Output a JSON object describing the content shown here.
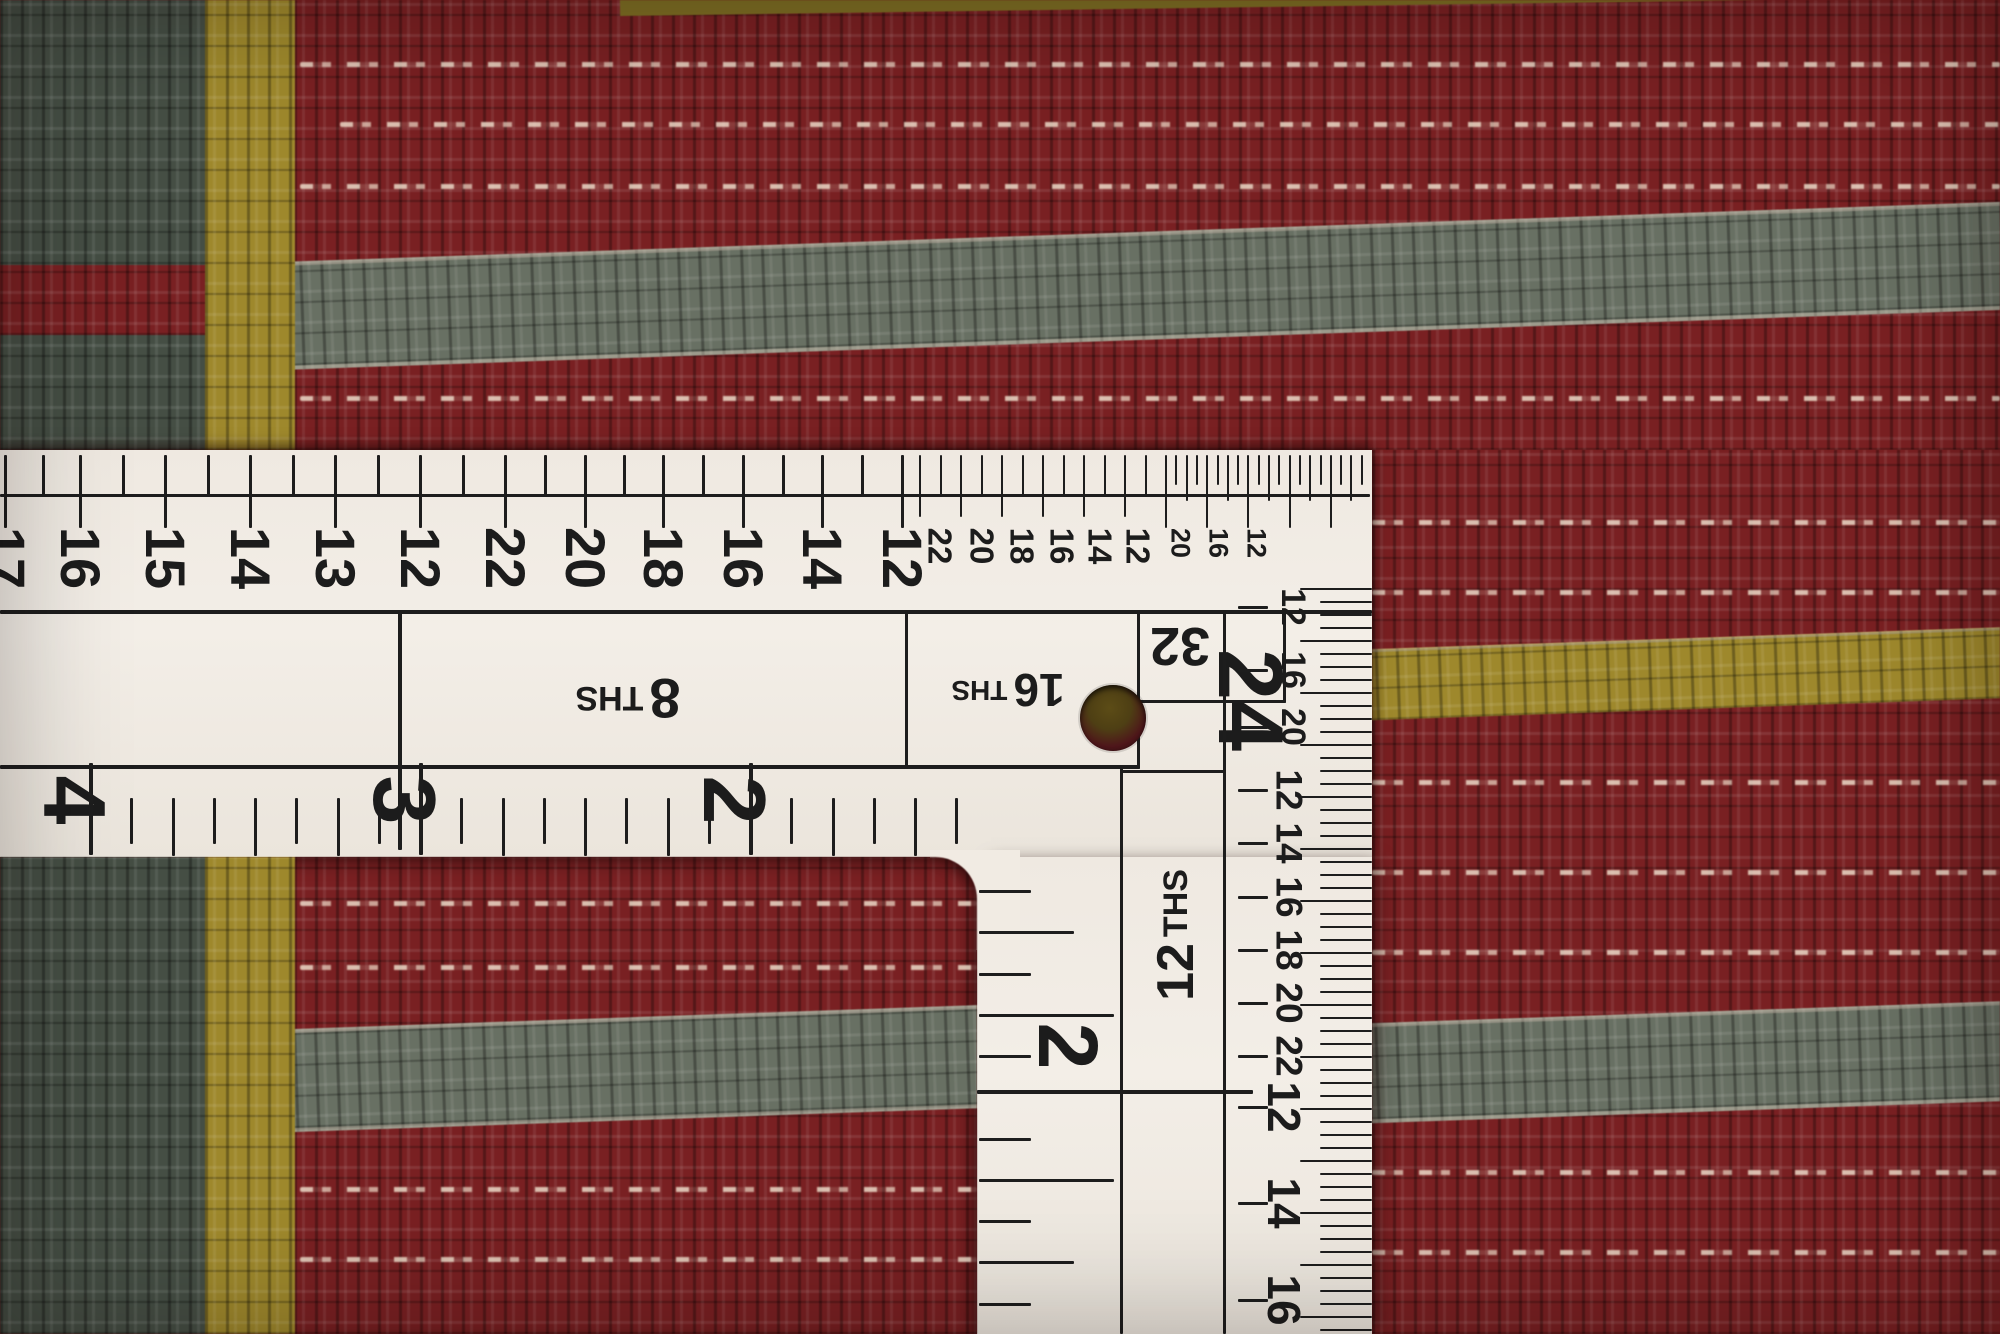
{
  "scene": {
    "subject": "Close-up photograph of a white tailor's L-square ruler lying on a striped hand-woven wool rug",
    "rug_stripe_colors": [
      "dark red",
      "gray green",
      "mustard gold",
      "dark teal",
      "cream weft"
    ]
  },
  "ruler": {
    "arm_top_scale": {
      "large_numbers": [
        "17",
        "16",
        "15",
        "14",
        "13",
        "12",
        "22",
        "20",
        "18",
        "16",
        "14",
        "12"
      ],
      "small_numbers": [
        "22",
        "20",
        "18",
        "16",
        "14",
        "12"
      ],
      "tiny_numbers": [
        "20",
        "16",
        "12"
      ]
    },
    "section_labels": {
      "eighths": "8 THS",
      "sixteenths": "16 THS",
      "thirty_seconds": "32",
      "twenty_fourths": "24",
      "twelfths": "12 THS"
    },
    "arm_bottom_inches": [
      "4",
      "3",
      "2"
    ],
    "vertical_inch": "2",
    "vertical_edge_numbers": [
      "12",
      "16",
      "20",
      "12",
      "14",
      "16",
      "18",
      "20",
      "22",
      "12",
      "14",
      "16"
    ]
  },
  "colors": {
    "ruler_body": "#f1ebe3",
    "print": "#1d1d1d",
    "rug_red": "#7c1f21",
    "rug_teal": "#454e44",
    "rug_gold": "#9f8828",
    "rug_gray": "#687063",
    "weft_cream": "#ead9c0"
  }
}
